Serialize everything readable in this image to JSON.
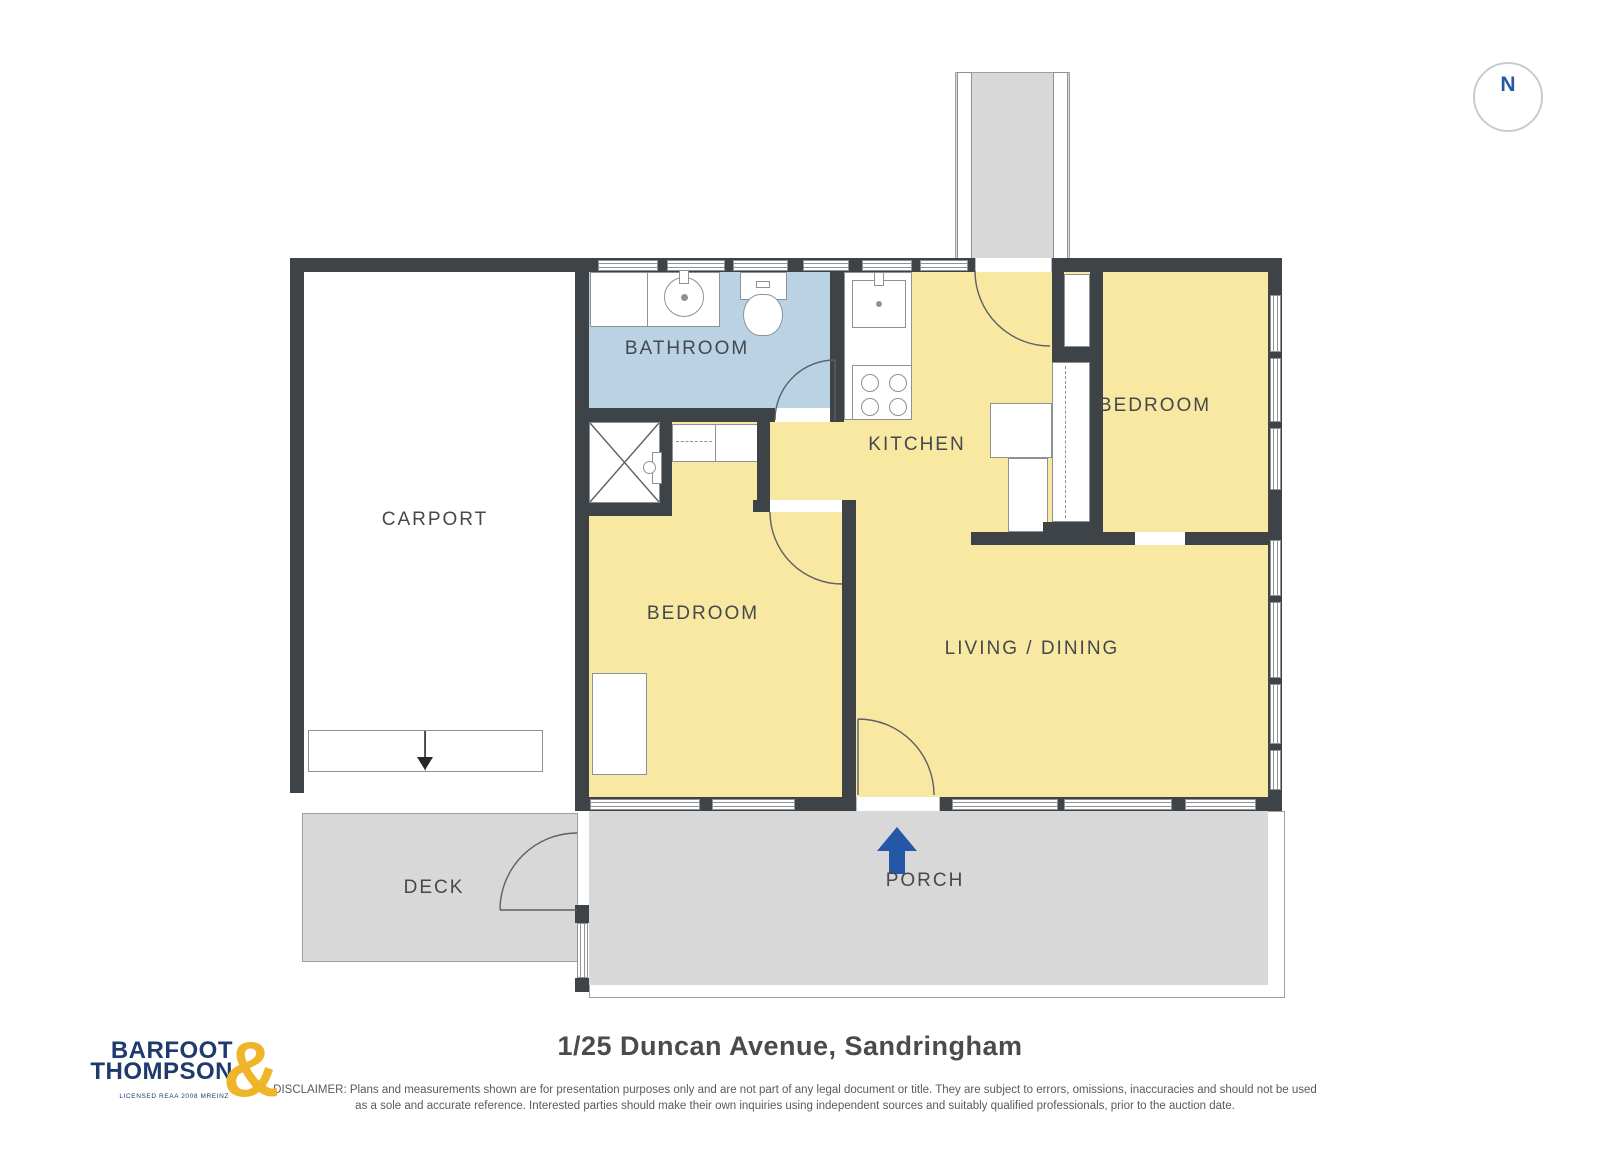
{
  "plan": {
    "type": "residential floor plan",
    "compass": {
      "label": "N"
    },
    "rooms": {
      "carport": "CARPORT",
      "bathroom": "BATHROOM",
      "kitchen": "KITCHEN",
      "bedroom_top_right": "BEDROOM",
      "bedroom_left": "BEDROOM",
      "living_dining": "LIVING / DINING",
      "deck": "DECK",
      "porch": "PORCH"
    }
  },
  "footer": {
    "title": "1/25 Duncan Avenue, Sandringham",
    "disclaimer_line1": "DISCLAIMER: Plans and measurements shown are for presentation purposes only and are not part of any legal document or title. They are subject to errors, omissions, inaccuracies and should not be used",
    "disclaimer_line2": "as a sole and accurate reference. Interested parties should make their own inquiries using independent sources and suitably qualified professionals, prior to the auction date."
  },
  "logo": {
    "line1": "BARFOOT",
    "line2": "THOMPSON",
    "ampersand": "&",
    "sub": "LICENSED REAA 2008 MREINZ"
  },
  "colors": {
    "room_fill": "#f8e8a2",
    "bathroom_fill": "#b9d3e5",
    "wall": "#3e4348",
    "outdoor_fill": "#d8d8d8",
    "accent_blue": "#2457a6",
    "logo_navy": "#1e3a6e",
    "logo_gold": "#f0b429"
  }
}
